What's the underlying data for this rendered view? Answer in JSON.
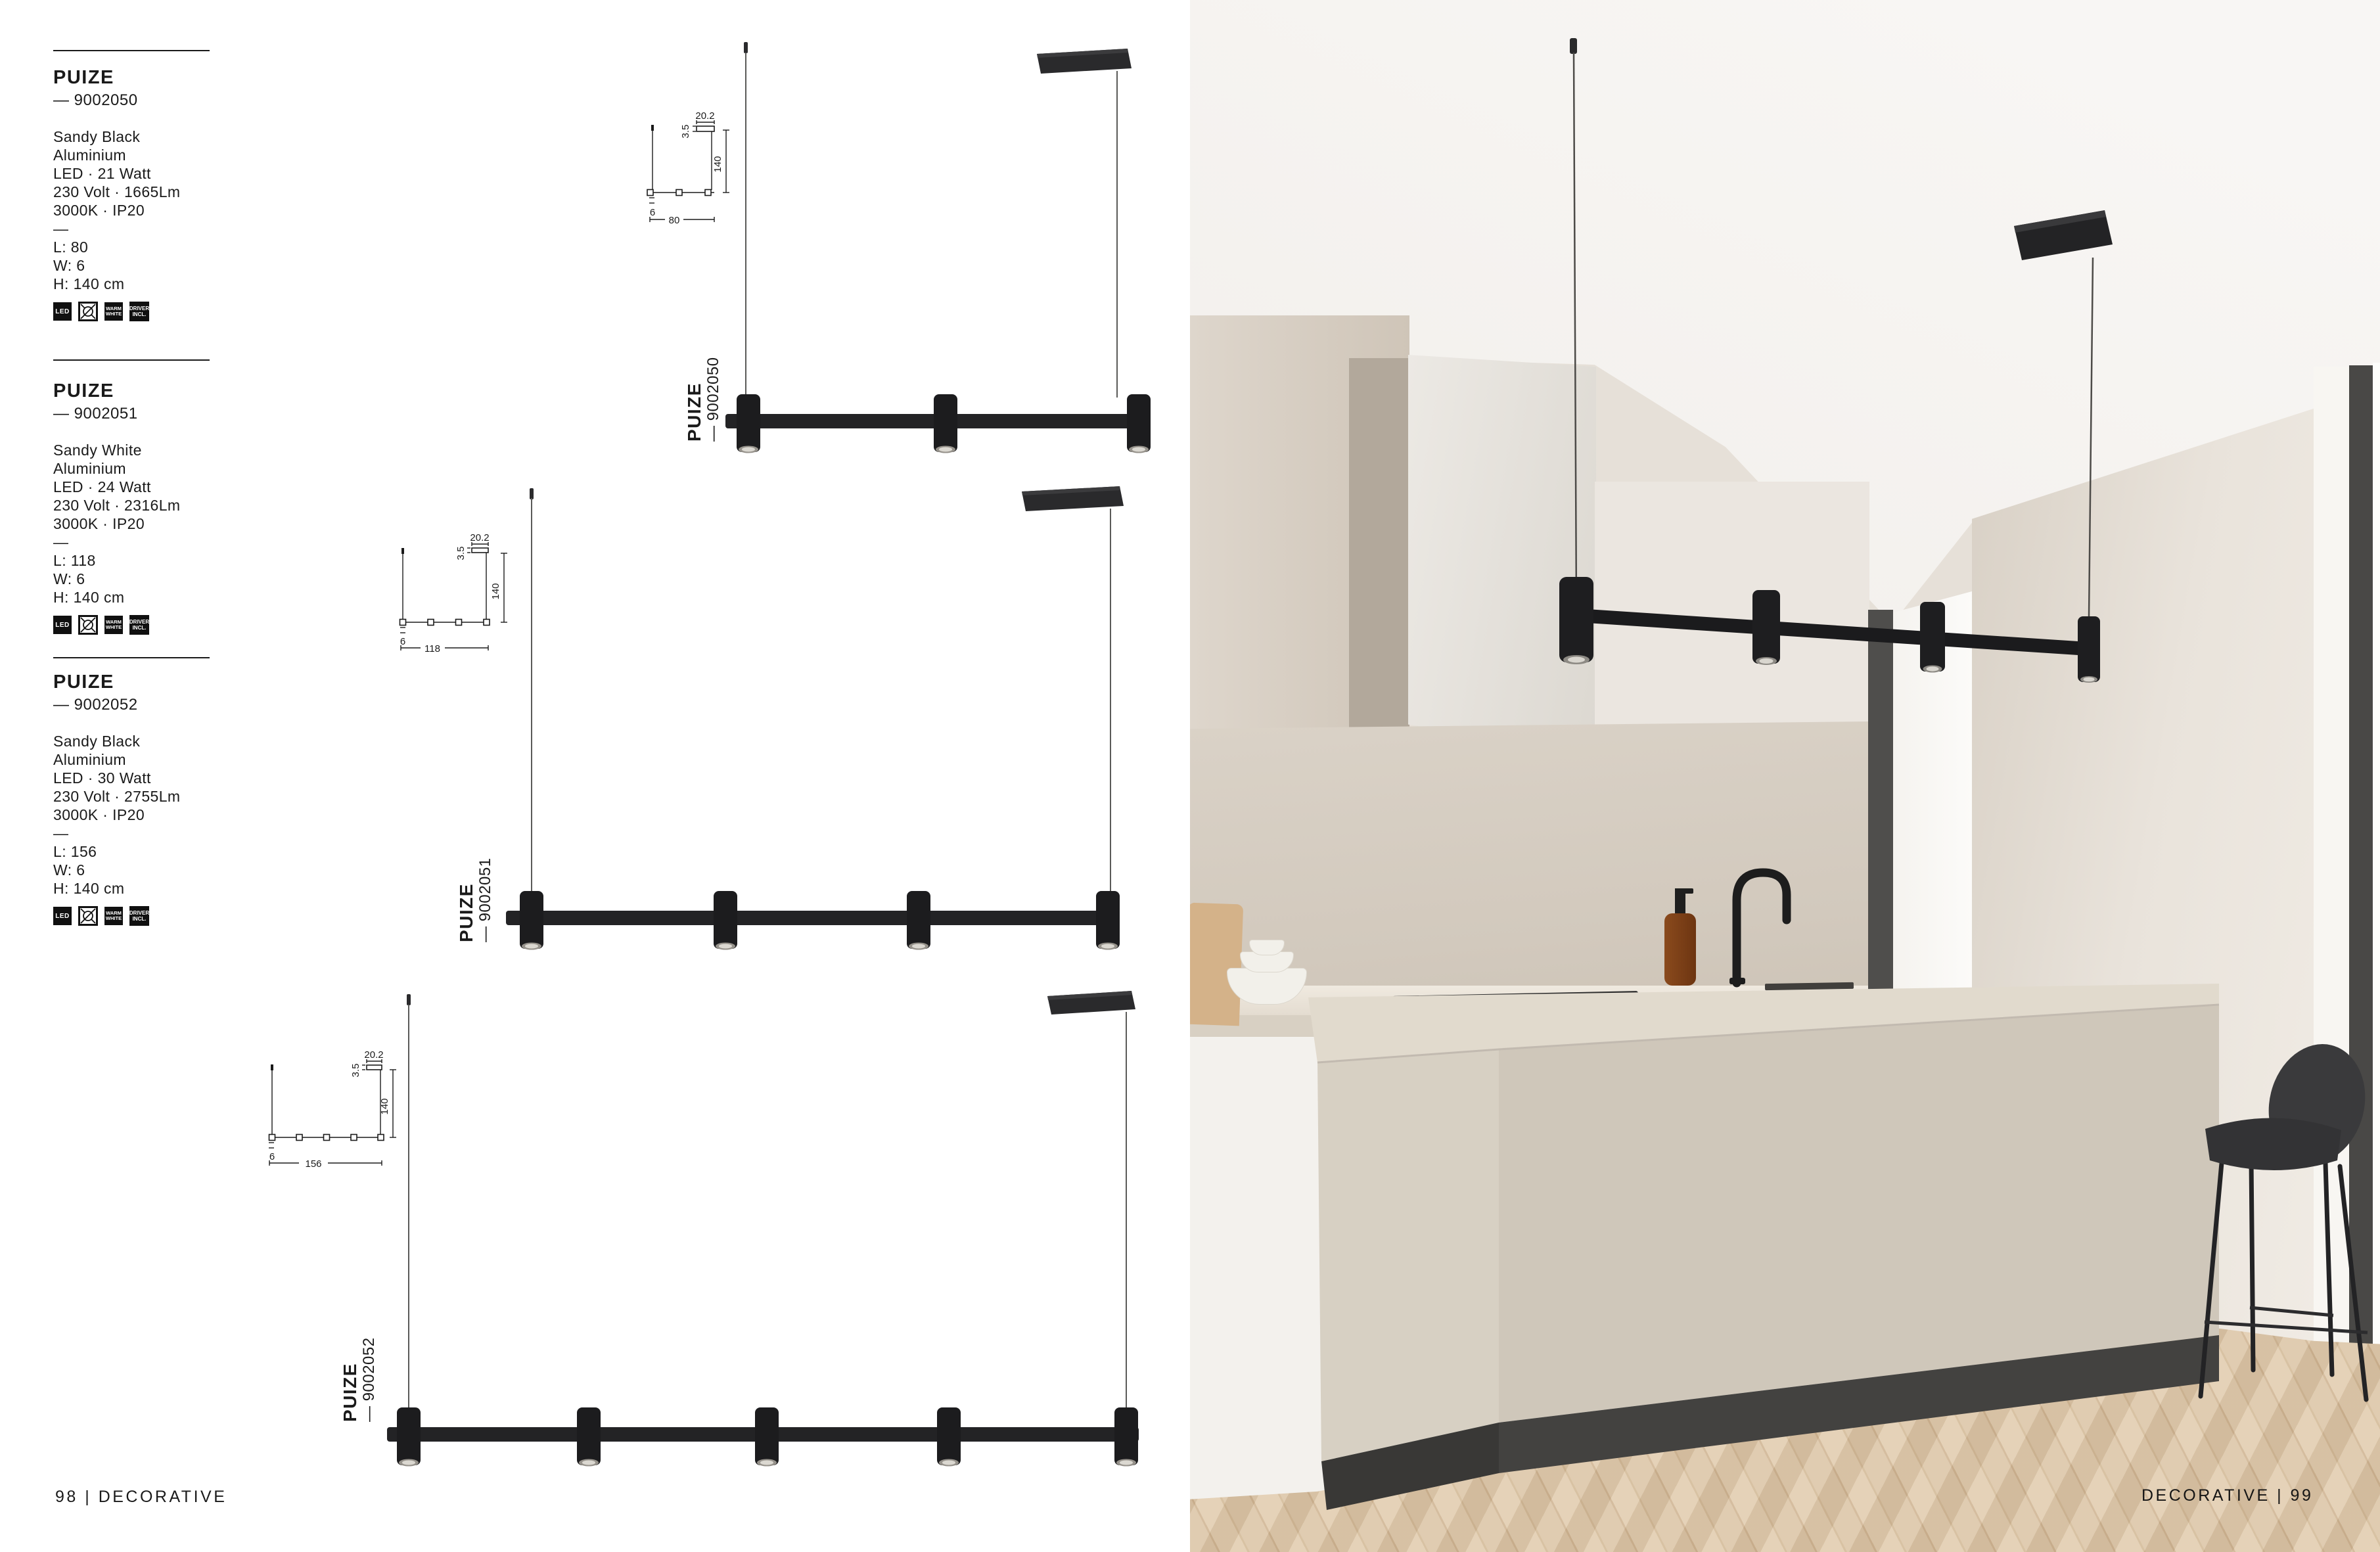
{
  "page": {
    "footer_left": "98 | DECORATIVE",
    "footer_right": "DECORATIVE | 99"
  },
  "badges": {
    "led": "LED",
    "bulb_excluded": "bulb-crossed",
    "warm_white": "WARM WHITE",
    "driver": "DRIVER INCL."
  },
  "products": [
    {
      "name": "PUIZE",
      "code": "— 9002050",
      "finish": "Sandy Black",
      "material": "Aluminium",
      "power": "LED · 21 Watt",
      "electrical": "230 Volt · 1665Lm",
      "temperature": "3000K · IP20",
      "separator": "—",
      "length": "L: 80",
      "width": "W: 6",
      "height": "H: 140 cm",
      "label_name": "PUIZE",
      "label_code": "— 9002050",
      "dims": {
        "canopy_w": "20.2",
        "canopy_h": "3.5",
        "drop": "140",
        "bar_l": "80",
        "bar_h": "6"
      }
    },
    {
      "name": "PUIZE",
      "code": "— 9002051",
      "finish": "Sandy White",
      "material": "Aluminium",
      "power": "LED · 24 Watt",
      "electrical": "230 Volt · 2316Lm",
      "temperature": "3000K · IP20",
      "separator": "—",
      "length": "L: 118",
      "width": "W: 6",
      "height": "H: 140 cm",
      "label_name": "PUIZE",
      "label_code": "— 9002051",
      "dims": {
        "canopy_w": "20.2",
        "canopy_h": "3.5",
        "drop": "140",
        "bar_l": "118",
        "bar_h": "6"
      }
    },
    {
      "name": "PUIZE",
      "code": "— 9002052",
      "finish": "Sandy Black",
      "material": "Aluminium",
      "power": "LED · 30 Watt",
      "electrical": "230 Volt · 2755Lm",
      "temperature": "3000K · IP20",
      "separator": "—",
      "length": "L: 156",
      "width": "W: 6",
      "height": "H: 140 cm",
      "label_name": "PUIZE",
      "label_code": "— 9002052",
      "dims": {
        "canopy_w": "20.2",
        "canopy_h": "3.5",
        "drop": "140",
        "bar_l": "156",
        "bar_h": "6"
      }
    }
  ],
  "colors": {
    "text": "#1a1a1a",
    "fixture_black": "#1c1c1e",
    "island": "#cfc7ba",
    "plinth": "#3e3d3b",
    "floor_oak": "#dcc6a8",
    "window_frame": "#4e4d4b"
  }
}
